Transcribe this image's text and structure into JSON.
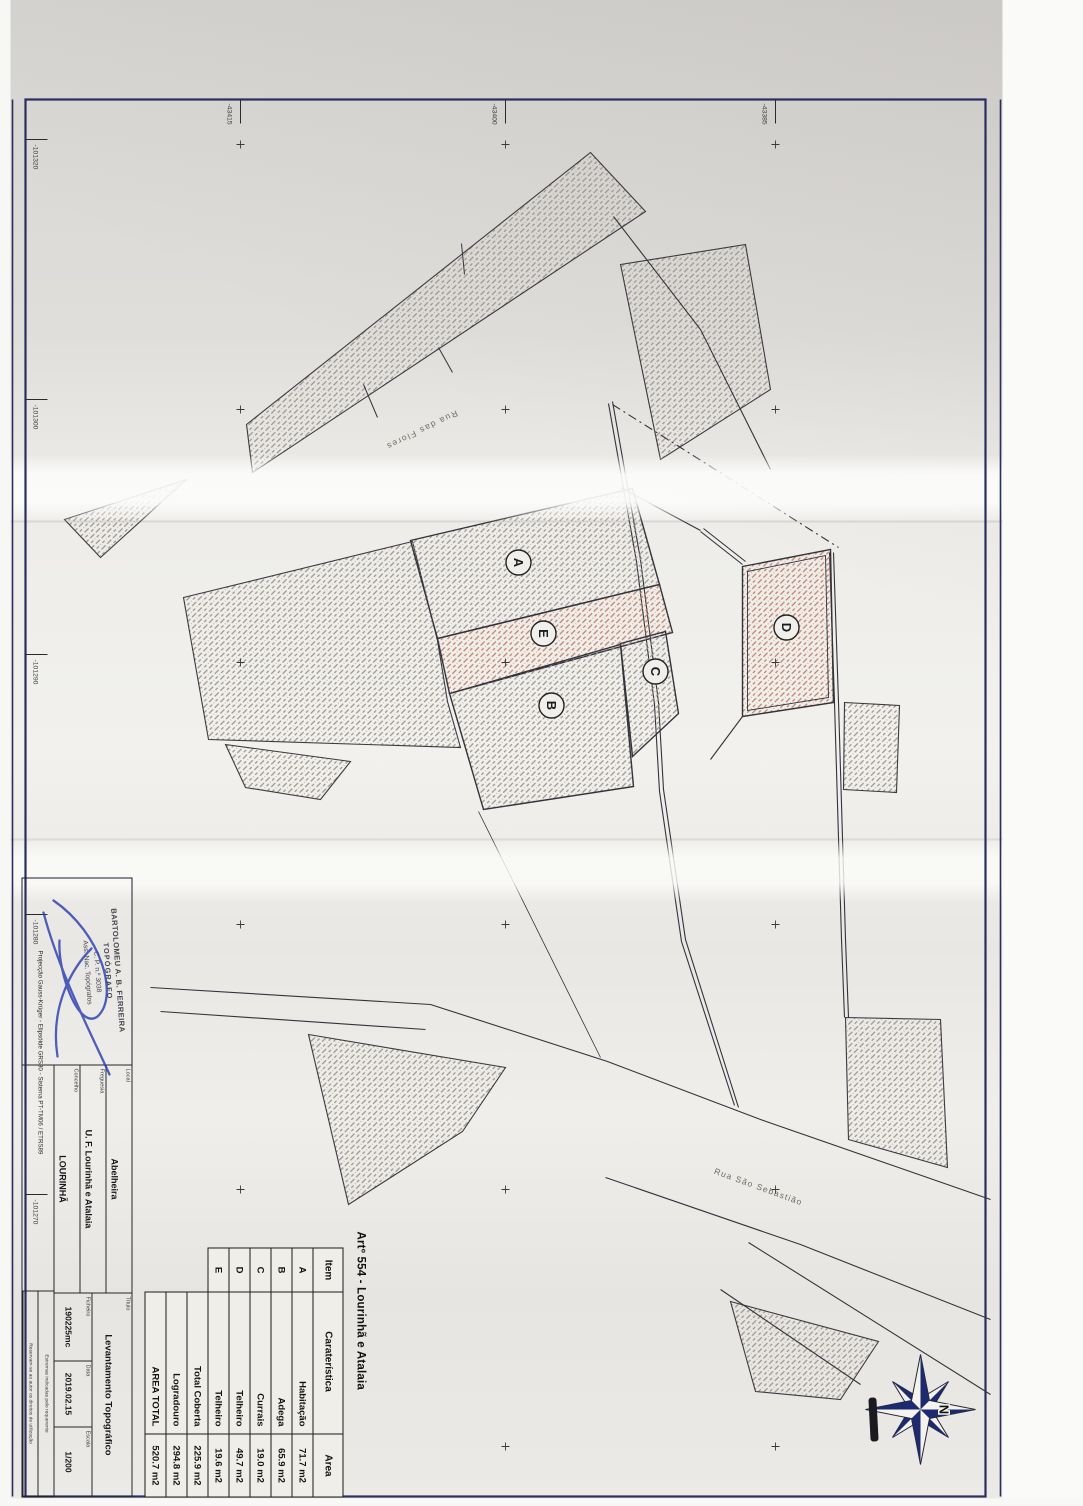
{
  "plan": {
    "art_title": "Artº 554 - Lourinhã e Atalaia",
    "table": {
      "headers": [
        "Item",
        "Caraterística",
        "Area"
      ],
      "rows": [
        [
          "A",
          "Habitação",
          "71.7 m2"
        ],
        [
          "B",
          "Adega",
          "65.9 m2"
        ],
        [
          "C",
          "Currais",
          "19.0 m2"
        ],
        [
          "D",
          "Telheiro",
          "49.7 m2"
        ],
        [
          "E",
          "Telheiro",
          "19.6 m2"
        ]
      ],
      "totals": [
        [
          "Total Coberta",
          "225.9 m2"
        ],
        [
          "Logradouro",
          "294.8 m2"
        ],
        [
          "AREA TOTAL",
          "520.7 m2"
        ]
      ]
    },
    "title_block": {
      "local_label": "Local",
      "local": "Abelheira",
      "freguesia_label": "Freguesia",
      "freguesia": "U. F. Lourinhã e Atalaia",
      "concelho_label": "Concelho",
      "concelho": "LOURINHÃ",
      "titulo_label": "Título",
      "titulo": "Levantamento Topográfico",
      "ficheiro_label": "Ficheiro",
      "ficheiro": "190225mc",
      "data_label": "Data",
      "data": "2019.02.15",
      "escala_label": "Escala",
      "escala": "1/200",
      "projection": "Projecção Gauss-Krüger - Elipsóide GRS80 - Sistema PT-TM06 / ETRS89",
      "note1": "Estremas indicadas pelo requerente",
      "note2": "Reservam-se ao autor os direitos de utilização"
    },
    "stamp": {
      "name": "BARTOLOMEU A. B. FERREIRA",
      "line2": "TOPÓGRAFO",
      "line3": "C. P. n.º 3038",
      "line4": "Ass. Nac. Topógrafos"
    },
    "map": {
      "streets": [
        "Rua das Flores",
        "Rua São Sebastião"
      ],
      "buildings": [
        "A",
        "B",
        "C",
        "D",
        "E"
      ],
      "easting_labels": [
        "-101320",
        "-101300",
        "-101290",
        "-101280",
        "-101270"
      ],
      "northing_labels": [
        "-43385",
        "-43400",
        "-43415"
      ],
      "north": "N"
    },
    "colors": {
      "paper": "#eceae6",
      "frame": "#2a2d5e",
      "ink": "#33333b",
      "hatch_gray": "#9b948b",
      "hatch_red": "#c07f68",
      "signature": "#2b3fae",
      "compass_dark": "#1d2a6e"
    }
  }
}
